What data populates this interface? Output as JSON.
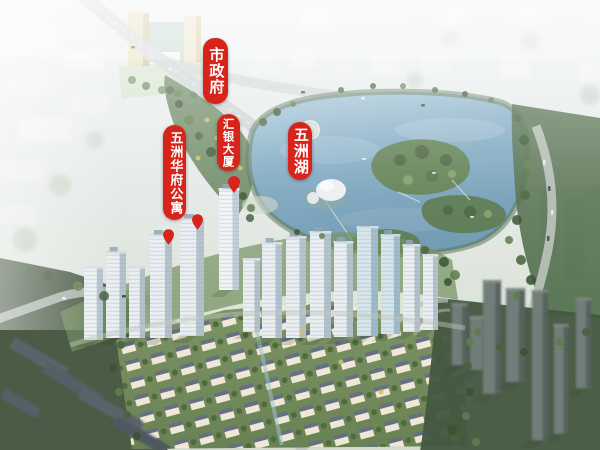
{
  "meta": {
    "type": "aerial-masterplan-rendering",
    "subject": "Bird's-eye architectural rendering of a lakeside residential development with red location callouts"
  },
  "annotations": {
    "marker_color": "#d8251c",
    "text_color": "#ffffff",
    "labels": [
      {
        "id": "city-government",
        "text": "市政府"
      },
      {
        "id": "huiyin-tower",
        "text": "汇银大厦"
      },
      {
        "id": "wuzhou-lake",
        "text": "五洲湖"
      },
      {
        "id": "wuzhou-huafu-apartments",
        "text": "五洲华府公寓"
      }
    ]
  },
  "scene": {
    "colors": {
      "lake": "#7ea9c2",
      "greenbelt": "#4e6a49",
      "haze_city": "#eef1f2",
      "tower_facade": "#e9eef2",
      "villa_wall": "#efe8d6",
      "villa_roof": "#667082"
    }
  }
}
